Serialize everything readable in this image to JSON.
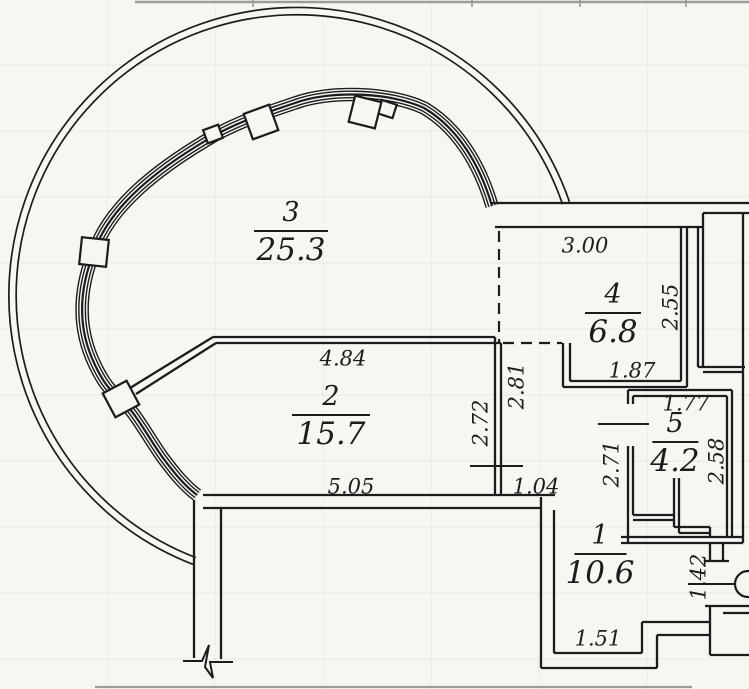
{
  "plan_type": "apartment-floor-plan",
  "colors": {
    "paper": "#f8f6f0",
    "ink": "#1c1c1c",
    "scan": "#9b9b9b"
  },
  "rooms": [
    {
      "number": "3",
      "area": "25.3"
    },
    {
      "number": "2",
      "area": "15.7"
    },
    {
      "number": "4",
      "area": "6.8"
    },
    {
      "number": "5",
      "area": "4.2"
    },
    {
      "number": "1",
      "area": "10.6"
    }
  ],
  "dimensions": [
    {
      "value": "3.00"
    },
    {
      "value": "2.55"
    },
    {
      "value": "1.87"
    },
    {
      "value": "1.77"
    },
    {
      "value": "2.81"
    },
    {
      "value": "2.72"
    },
    {
      "value": "4.84"
    },
    {
      "value": "5.05"
    },
    {
      "value": "1.04"
    },
    {
      "value": "2.71"
    },
    {
      "value": "2.58"
    },
    {
      "value": "1.51"
    },
    {
      "value": "1.42"
    }
  ]
}
